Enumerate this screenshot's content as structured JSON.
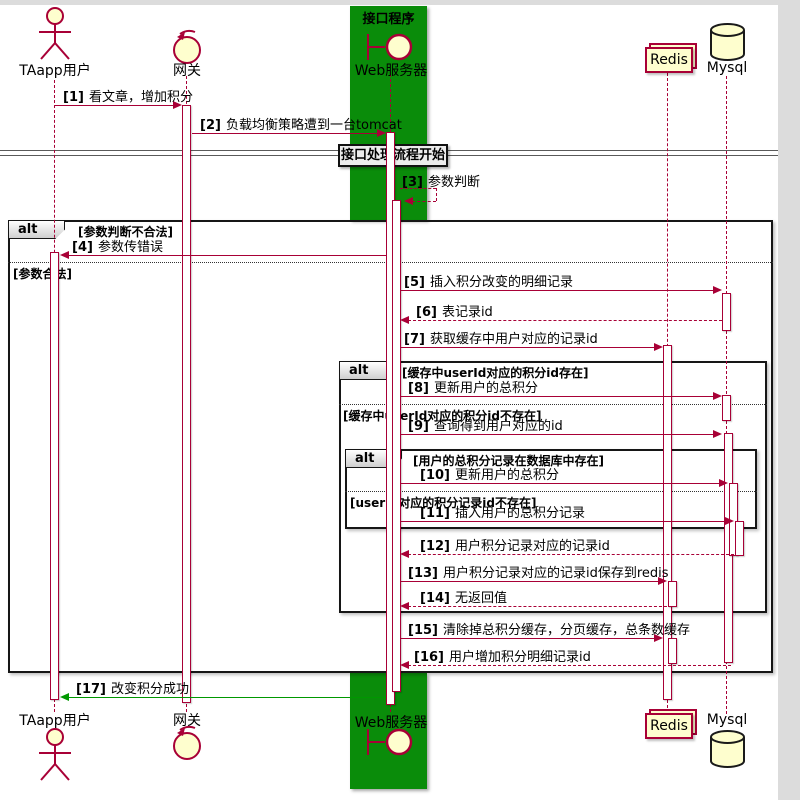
{
  "diagram": {
    "box_label": "接口程序",
    "divider_label": "接口处理流程开始"
  },
  "participants": {
    "user": "TAapp用户",
    "gateway": "网关",
    "webserver": "Web服务器",
    "redis": "Redis",
    "mysql": "Mysql"
  },
  "fragments": {
    "alt1": {
      "operator": "alt",
      "guard_true": "[参数判断不合法]",
      "guard_false": "[参数合法]"
    },
    "alt2": {
      "operator": "alt",
      "guard_true": "[缓存中userId对应的积分id存在]",
      "guard_false": "[缓存中userId对应的积分id不存在]"
    },
    "alt3": {
      "operator": "alt",
      "guard_true": "[用户的总积分记录在数据库中存在]",
      "guard_false": "[userId对应的积分记录id不存在]"
    }
  },
  "messages": [
    {
      "num": "[1]",
      "text": "看文章，增加积分"
    },
    {
      "num": "[2]",
      "text": "负载均衡策略遭到一台tomcat"
    },
    {
      "num": "[3]",
      "text": "参数判断"
    },
    {
      "num": "[4]",
      "text": "参数传错误"
    },
    {
      "num": "[5]",
      "text": "插入积分改变的明细记录"
    },
    {
      "num": "[6]",
      "text": "表记录id"
    },
    {
      "num": "[7]",
      "text": "获取缓存中用户对应的记录id"
    },
    {
      "num": "[8]",
      "text": "更新用户的总积分"
    },
    {
      "num": "[9]",
      "text": "查询得到用户对应的id"
    },
    {
      "num": "[10]",
      "text": "更新用户的总积分"
    },
    {
      "num": "[11]",
      "text": "插入用户的总积分记录"
    },
    {
      "num": "[12]",
      "text": "用户积分记录对应的记录id"
    },
    {
      "num": "[13]",
      "text": "用户积分记录对应的记录id保存到redis"
    },
    {
      "num": "[14]",
      "text": "无返回值"
    },
    {
      "num": "[15]",
      "text": "清除掉总积分缓存，分页缓存，总条数缓存"
    },
    {
      "num": "[16]",
      "text": "用户增加积分明细记录id"
    },
    {
      "num": "[17]",
      "text": "改变积分成功"
    }
  ],
  "colors": {
    "line": "#A80036",
    "frame": "#161616",
    "participant_fill": "#FEFECE",
    "box_green": "#0a8c0a",
    "success_arrow": "#009800"
  }
}
